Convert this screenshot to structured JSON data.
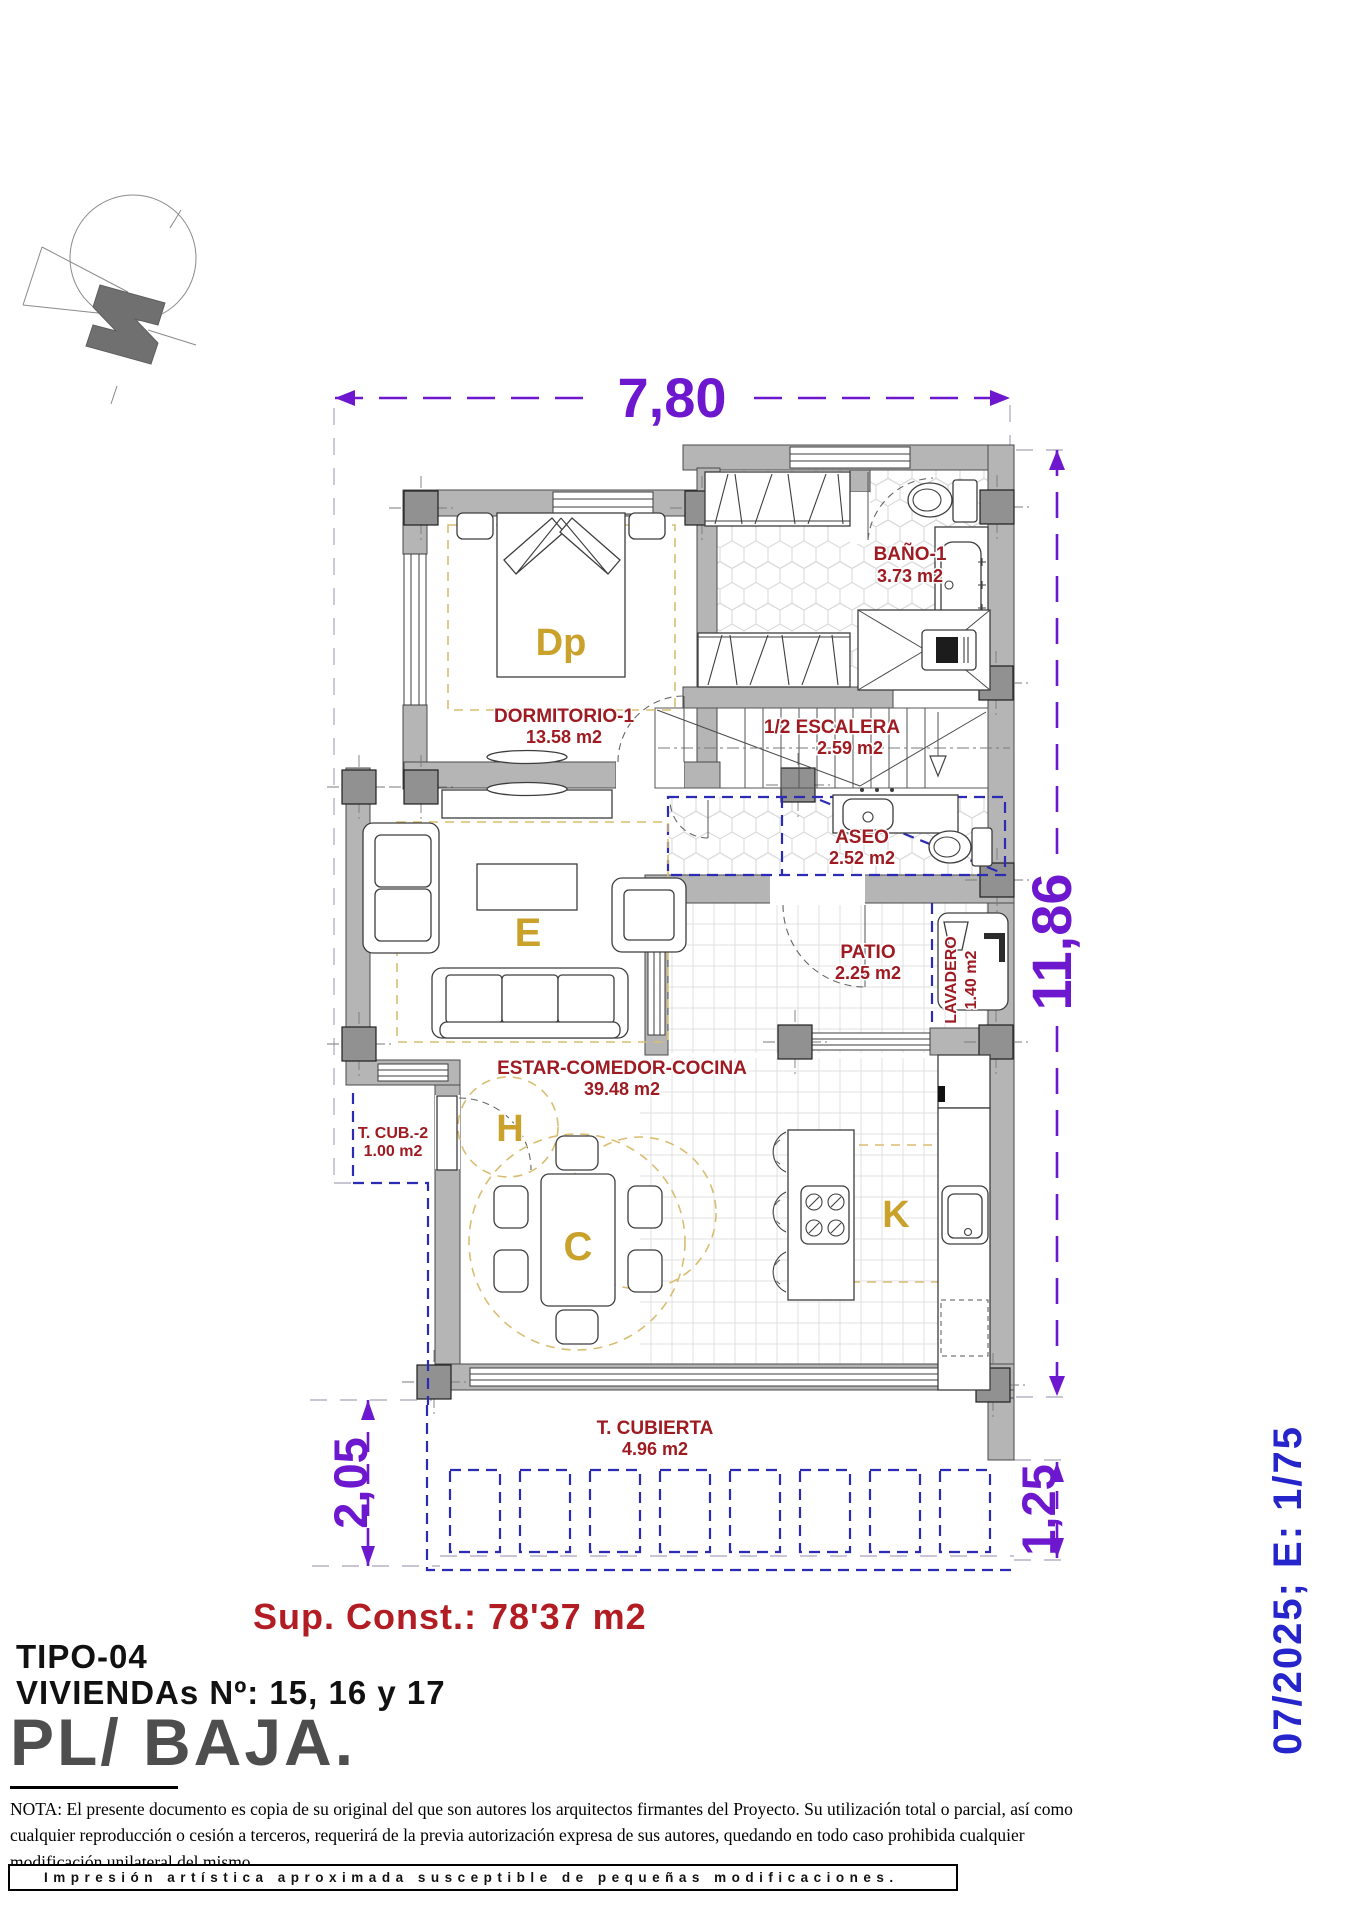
{
  "dimensions": {
    "top": "7,80",
    "right": "11,86",
    "bottom_left": "2,05",
    "bottom_right": "1,25"
  },
  "scale_note": "07/2025; E: 1/75",
  "rooms": {
    "bano": {
      "name": "BAÑO-1",
      "area": "3.73 m2"
    },
    "dormitorio": {
      "name": "DORMITORIO-1",
      "area": "13.58 m2",
      "letter": "Dp"
    },
    "escalera": {
      "name": "1/2 ESCALERA",
      "area": "2.59 m2"
    },
    "aseo": {
      "name": "ASEO",
      "area": "2.52 m2"
    },
    "patio": {
      "name": "PATIO",
      "area": "2.25 m2"
    },
    "lavadero": {
      "name": "LAVADERO",
      "area": "1.40 m2"
    },
    "estar": {
      "name": "ESTAR-COMEDOR-COCINA",
      "area": "39.48 m2",
      "letter_living": "E",
      "letter_hall": "H",
      "letter_dining": "C",
      "letter_kitchen": "K"
    },
    "tcub2": {
      "name": "T. CUB.-2",
      "area": "1.00 m2"
    },
    "tcubierta": {
      "name": "T. CUBIERTA",
      "area": "4.96 m2"
    }
  },
  "title_block": {
    "sup_const": "Sup. Const.: 78'37 m2",
    "tipo": "TIPO-04",
    "viviendas": "VIVIENDAs Nº: 15, 16 y 17",
    "planta": "PL/ BAJA."
  },
  "nota": "NOTA: El presente documento es copia de su original del que son autores los arquitectos firmantes del Proyecto. Su utilización total o parcial, así como cualquier reproducción o cesión a terceros, requerirá  de la previa autorización expresa de sus autores, quedando en todo caso prohibida cualquier modificación unilateral del mismo.",
  "footer_strip": "Impresión  artística  aproximada  susceptible  de  pequeñas  modificaciones.",
  "colors": {
    "dimension_purple": "#6d17cf",
    "date_blue": "#2525cb",
    "room_red": "#9e1b22",
    "letter_gold": "#c9a12b",
    "wall_gray": "#b5b5b5",
    "zone_blue_dash": "#2b2bb5"
  }
}
